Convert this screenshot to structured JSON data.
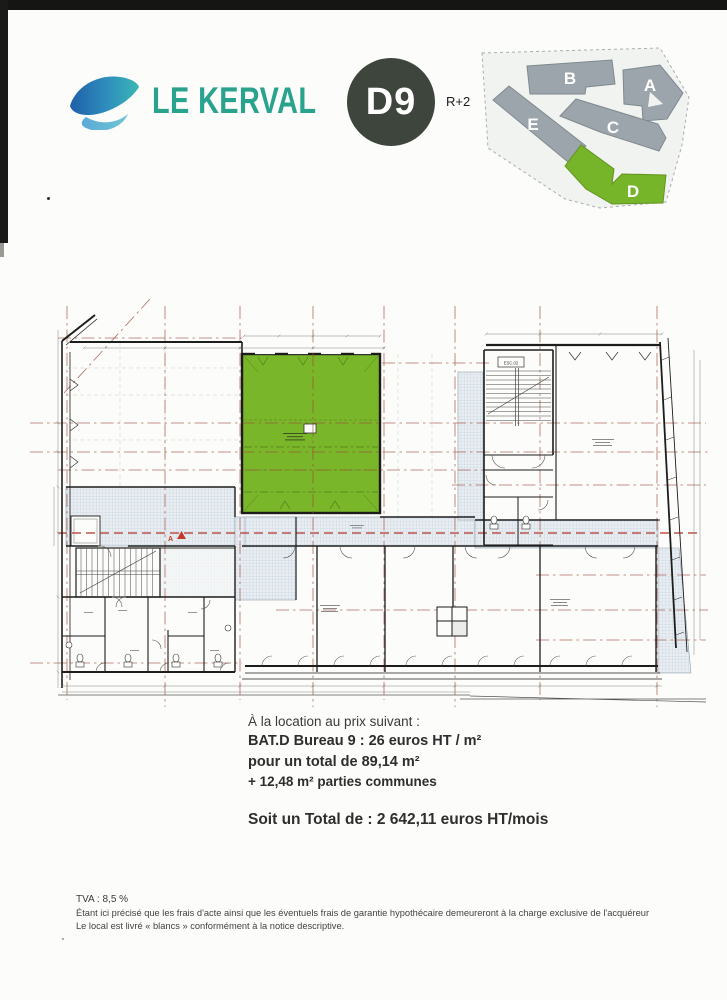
{
  "header": {
    "logo_text": "LE KERVAL",
    "unit_badge": "D9",
    "level": "R+2",
    "brand_teal": "#2aa38e",
    "badge_bg": "#3e453d"
  },
  "site_map": {
    "building_color": "#9ba5ab",
    "highlight_color": "#76b42a",
    "buildings": [
      {
        "label": "B",
        "highlighted": false
      },
      {
        "label": "A",
        "highlighted": false
      },
      {
        "label": "E",
        "highlighted": false
      },
      {
        "label": "C",
        "highlighted": false
      },
      {
        "label": "D",
        "highlighted": true
      }
    ]
  },
  "floor_plan": {
    "highlight_color": "#79b629",
    "grid_line_color": "#a04a38",
    "stair_label": "ESC.02",
    "section_marker": "A"
  },
  "pricing": {
    "intro": "À la location au prix suivant :",
    "line1": "BAT.D Bureau 9 : 26 euros HT / m²",
    "line2": "pour un total de 89,14 m²",
    "line3": "+ 12,48 m² parties communes",
    "total": "Soit un Total de : 2 642,11 euros HT/mois"
  },
  "footer": {
    "tva": "TVA : 8,5 %",
    "line1": "Étant ici précisé que les frais d'acte ainsi que les éventuels frais de garantie hypothécaire demeureront à la charge exclusive de l'acquéreur",
    "line2": "Le local est livré « blancs » conformément à la notice descriptive."
  }
}
